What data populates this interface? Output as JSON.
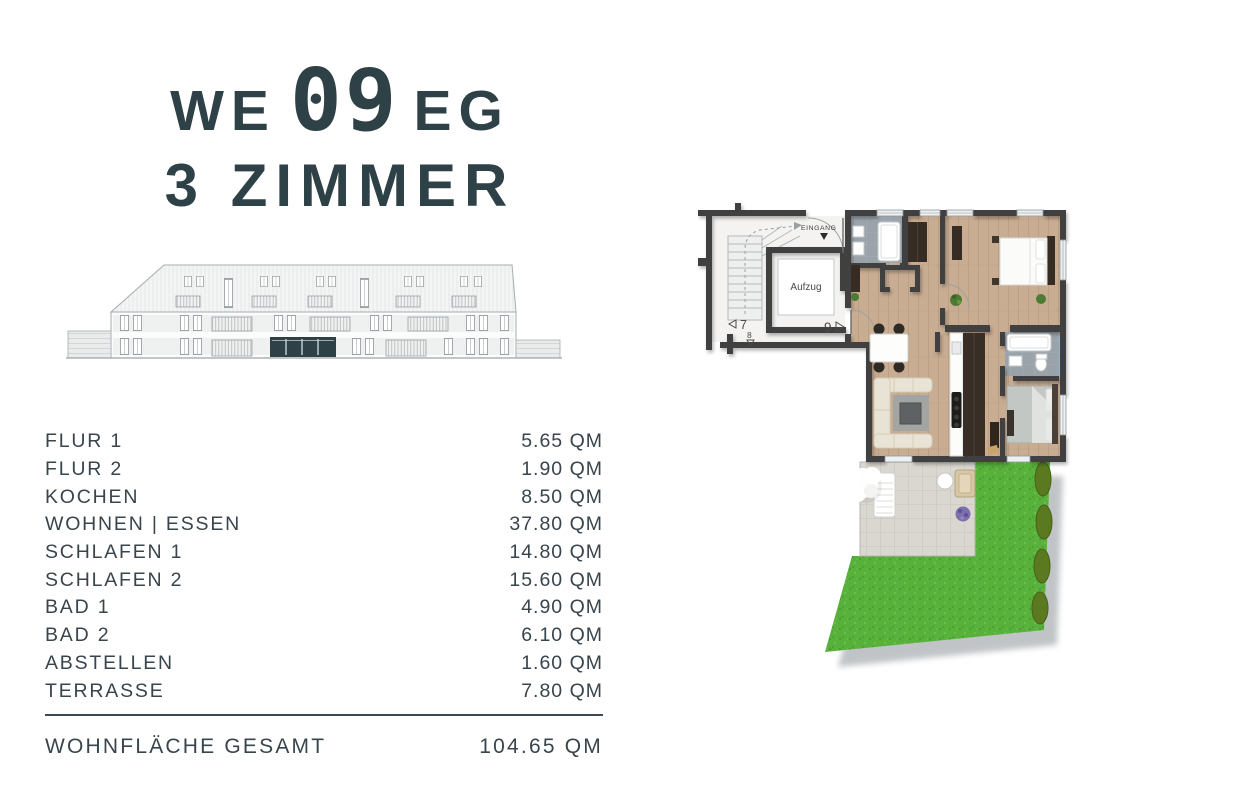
{
  "title": {
    "we": "WE",
    "number": "09",
    "floor": "EG",
    "line2": "3 ZIMMER"
  },
  "colors": {
    "accent": "#2d4147",
    "text": "#39454c",
    "wall": "#3f3f3f",
    "wood_floor": "#c9ad92",
    "bath_floor": "#9aa3aa",
    "paving": "#dad7d1",
    "grass": "#58b13b",
    "hedge": "#5b7a1f",
    "highlight_unit": "#2d4147"
  },
  "rooms": {
    "unit": "QM",
    "rows": [
      {
        "label": "FLUR 1",
        "area": "5.65 QM"
      },
      {
        "label": "FLUR 2",
        "area": "1.90 QM"
      },
      {
        "label": "KOCHEN",
        "area": "8.50 QM"
      },
      {
        "label": "WOHNEN | ESSEN",
        "area": "37.80 QM"
      },
      {
        "label": "SCHLAFEN 1",
        "area": "14.80 QM"
      },
      {
        "label": "SCHLAFEN 2",
        "area": "15.60 QM"
      },
      {
        "label": "BAD 1",
        "area": "4.90 QM"
      },
      {
        "label": "BAD 2",
        "area": "6.10 QM"
      },
      {
        "label": "ABSTELLEN",
        "area": "1.60 QM"
      },
      {
        "label": "TERRASSE",
        "area": "7.80 QM"
      }
    ]
  },
  "total": {
    "label": "WOHNFLÄCHE GESAMT",
    "area": "104.65 QM"
  },
  "floorplan": {
    "entrance_label": "EINGANG",
    "elevator_label": "Aufzug",
    "unit_left": "7",
    "unit_current": "9",
    "unit_down": "8"
  }
}
